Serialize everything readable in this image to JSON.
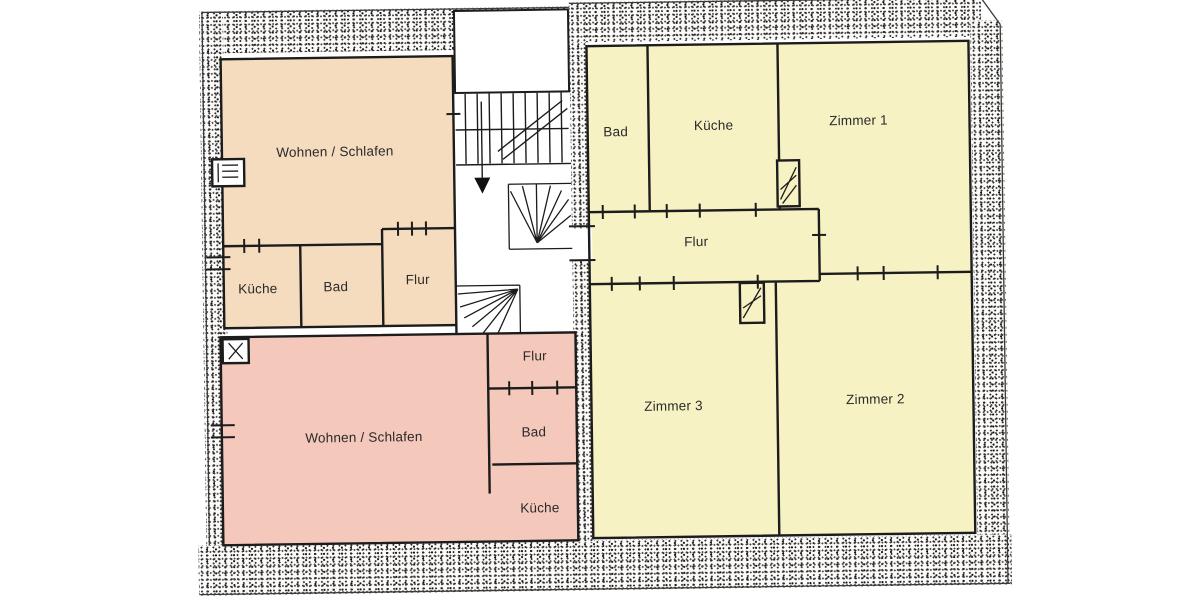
{
  "floor_plan": {
    "colors": {
      "apartment_top_left": "#f6dcbf",
      "apartment_bottom_left": "#f4c8bb",
      "apartment_right": "#f6f2c4",
      "wall_line": "#1c1c1c",
      "paper": "#ffffff"
    },
    "apartments": [
      {
        "name": "apartment-top-left",
        "rooms": [
          {
            "label": "Wohnen / Schlafen"
          },
          {
            "label": "Küche"
          },
          {
            "label": "Bad"
          },
          {
            "label": "Flur"
          }
        ]
      },
      {
        "name": "apartment-bottom-left",
        "rooms": [
          {
            "label": "Wohnen / Schlafen"
          },
          {
            "label": "Flur"
          },
          {
            "label": "Bad"
          },
          {
            "label": "Küche"
          }
        ]
      },
      {
        "name": "apartment-right",
        "rooms": [
          {
            "label": "Bad"
          },
          {
            "label": "Küche"
          },
          {
            "label": "Zimmer 1"
          },
          {
            "label": "Flur"
          },
          {
            "label": "Zimmer 3"
          },
          {
            "label": "Zimmer 2"
          }
        ]
      }
    ]
  }
}
